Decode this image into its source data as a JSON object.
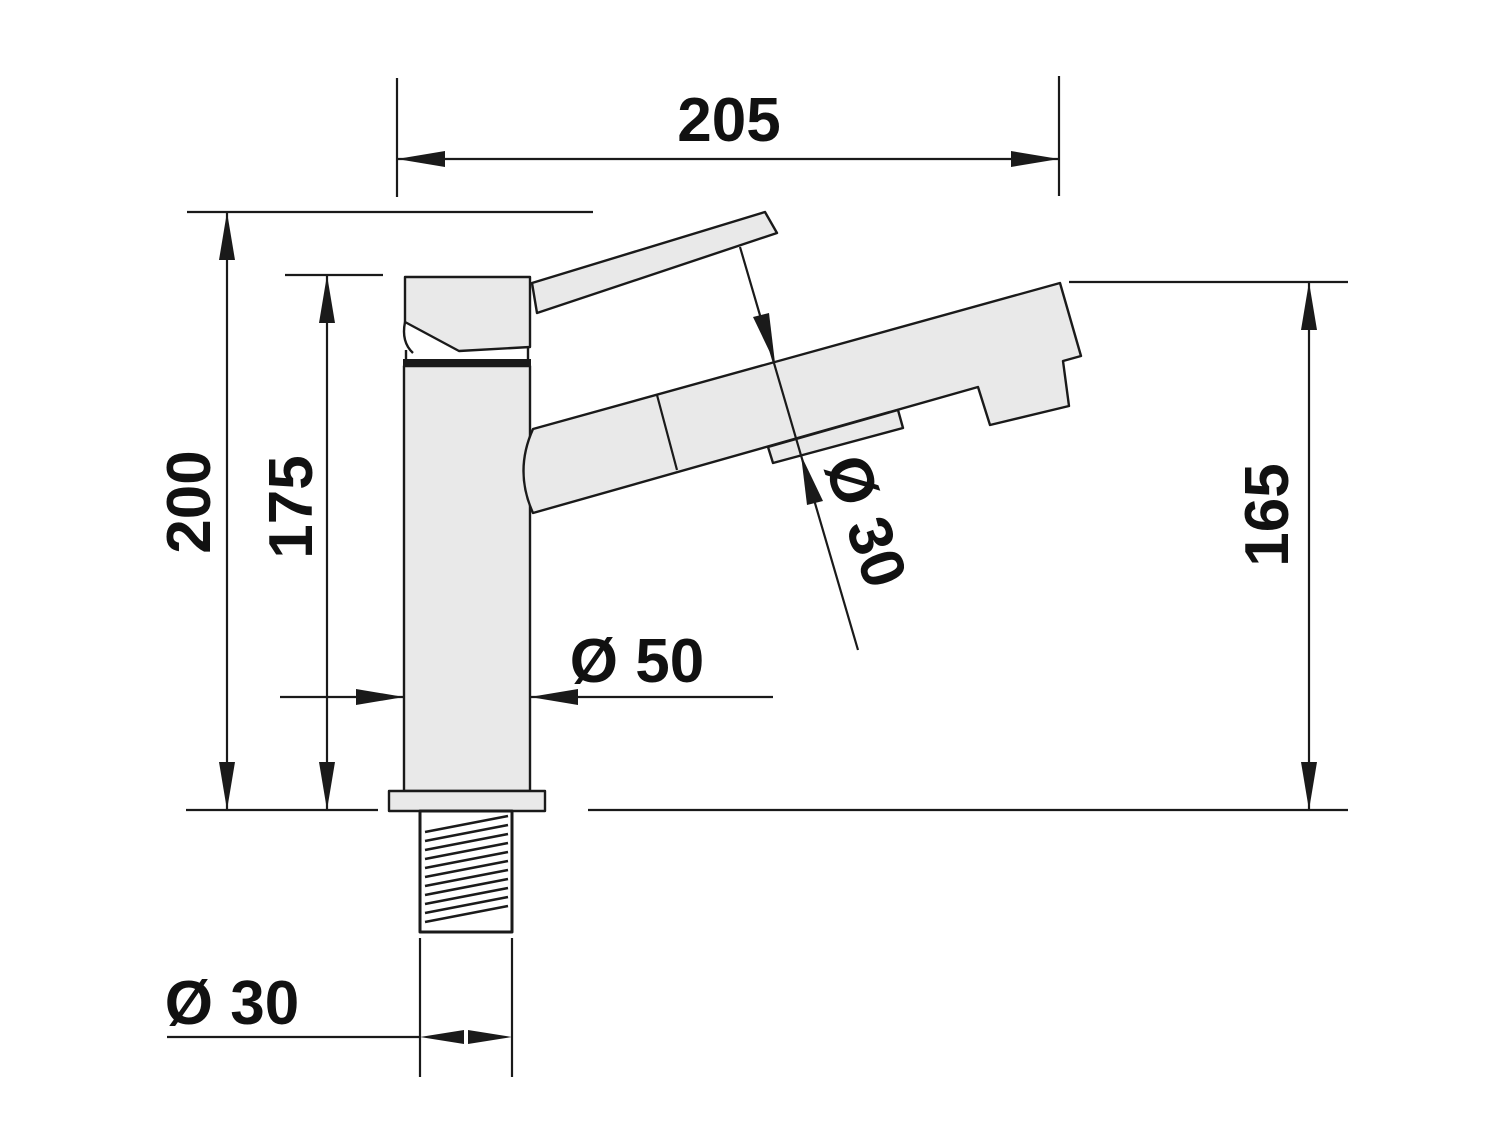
{
  "drawing": {
    "kind": "technical-dimension-drawing",
    "subject": "single-lever-faucet-side-view",
    "units_implied": "mm",
    "dimensions": {
      "top_width": "205",
      "overall_height": "200",
      "body_height": "175",
      "spout_tube_diameter": "Ø 30",
      "body_diameter": "Ø 50",
      "spout_outlet_height": "165",
      "thread_diameter": "Ø 30"
    }
  },
  "colors": {
    "background": "#ffffff",
    "outline": "#1a1a1a",
    "part_fill": "#e9e9e9",
    "text": "#111111"
  }
}
